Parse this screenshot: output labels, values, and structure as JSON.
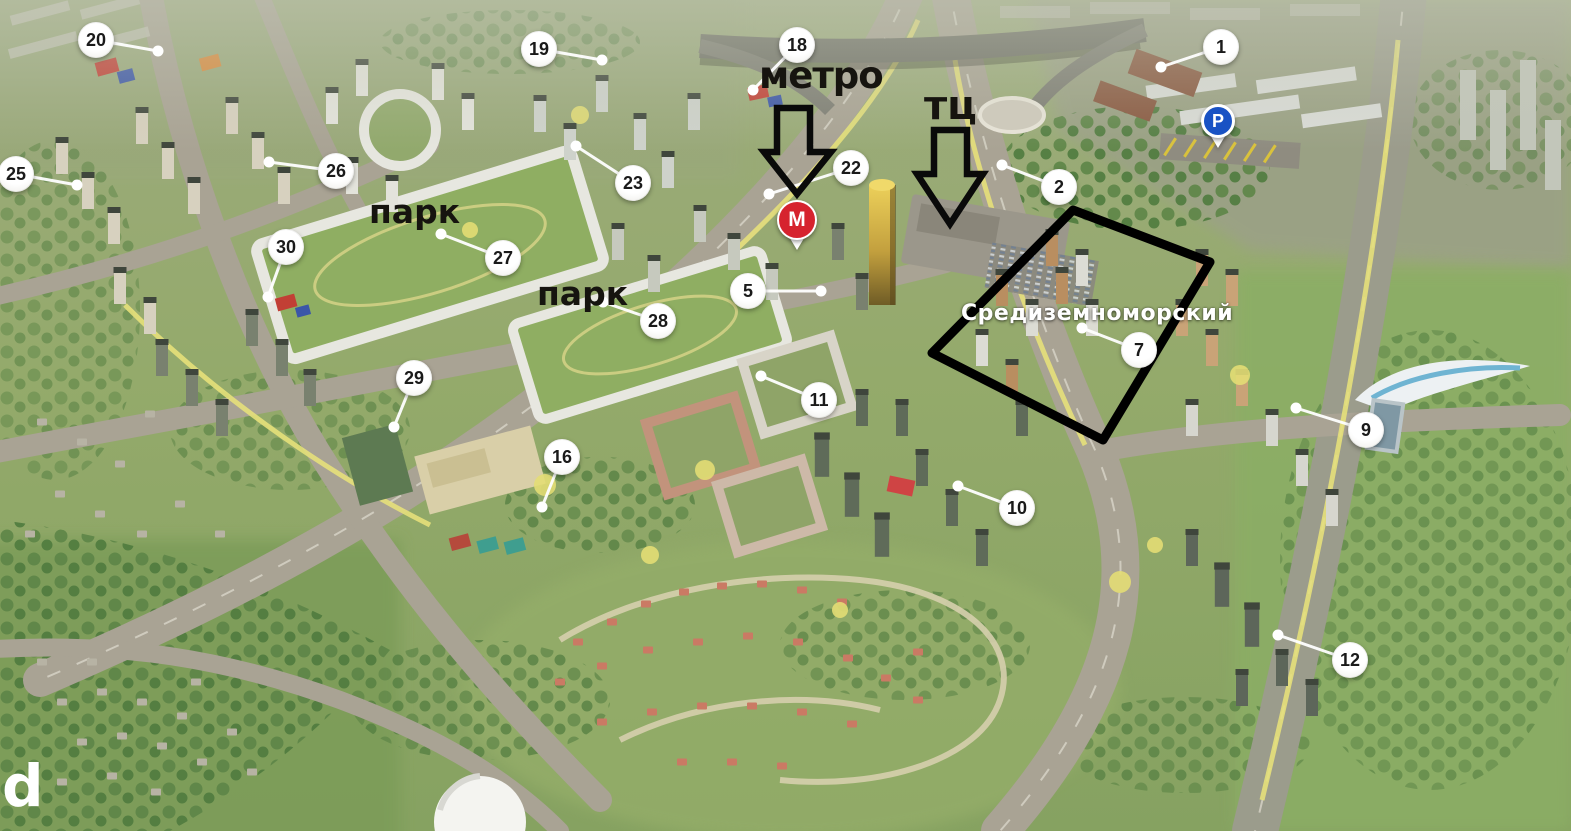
{
  "map": {
    "title": "aerial-development-map",
    "annotations": {
      "metro_label": "метро",
      "mall_label": "тц",
      "park_label_1": "парк",
      "park_label_2": "парк",
      "complex_label": "Средиземноморский",
      "watermark_letter": "d"
    },
    "pins": {
      "metro_letter": "М",
      "parking_letter": "P"
    },
    "markers": [
      {
        "label": "1"
      },
      {
        "label": "2"
      },
      {
        "label": "5"
      },
      {
        "label": "7"
      },
      {
        "label": "9"
      },
      {
        "label": "10"
      },
      {
        "label": "11"
      },
      {
        "label": "12"
      },
      {
        "label": "16"
      },
      {
        "label": "18"
      },
      {
        "label": "19"
      },
      {
        "label": "20"
      },
      {
        "label": "22"
      },
      {
        "label": "23"
      },
      {
        "label": "25"
      },
      {
        "label": "26"
      },
      {
        "label": "27"
      },
      {
        "label": "28"
      },
      {
        "label": "29"
      },
      {
        "label": "30"
      }
    ],
    "colors": {
      "metro_red": "#d6232e",
      "parking_blue": "#1952c4",
      "marker_bg": "#ffffff",
      "annotation_black": "#111111",
      "district_outline": "#000000",
      "label_white": "#ffffff"
    }
  }
}
